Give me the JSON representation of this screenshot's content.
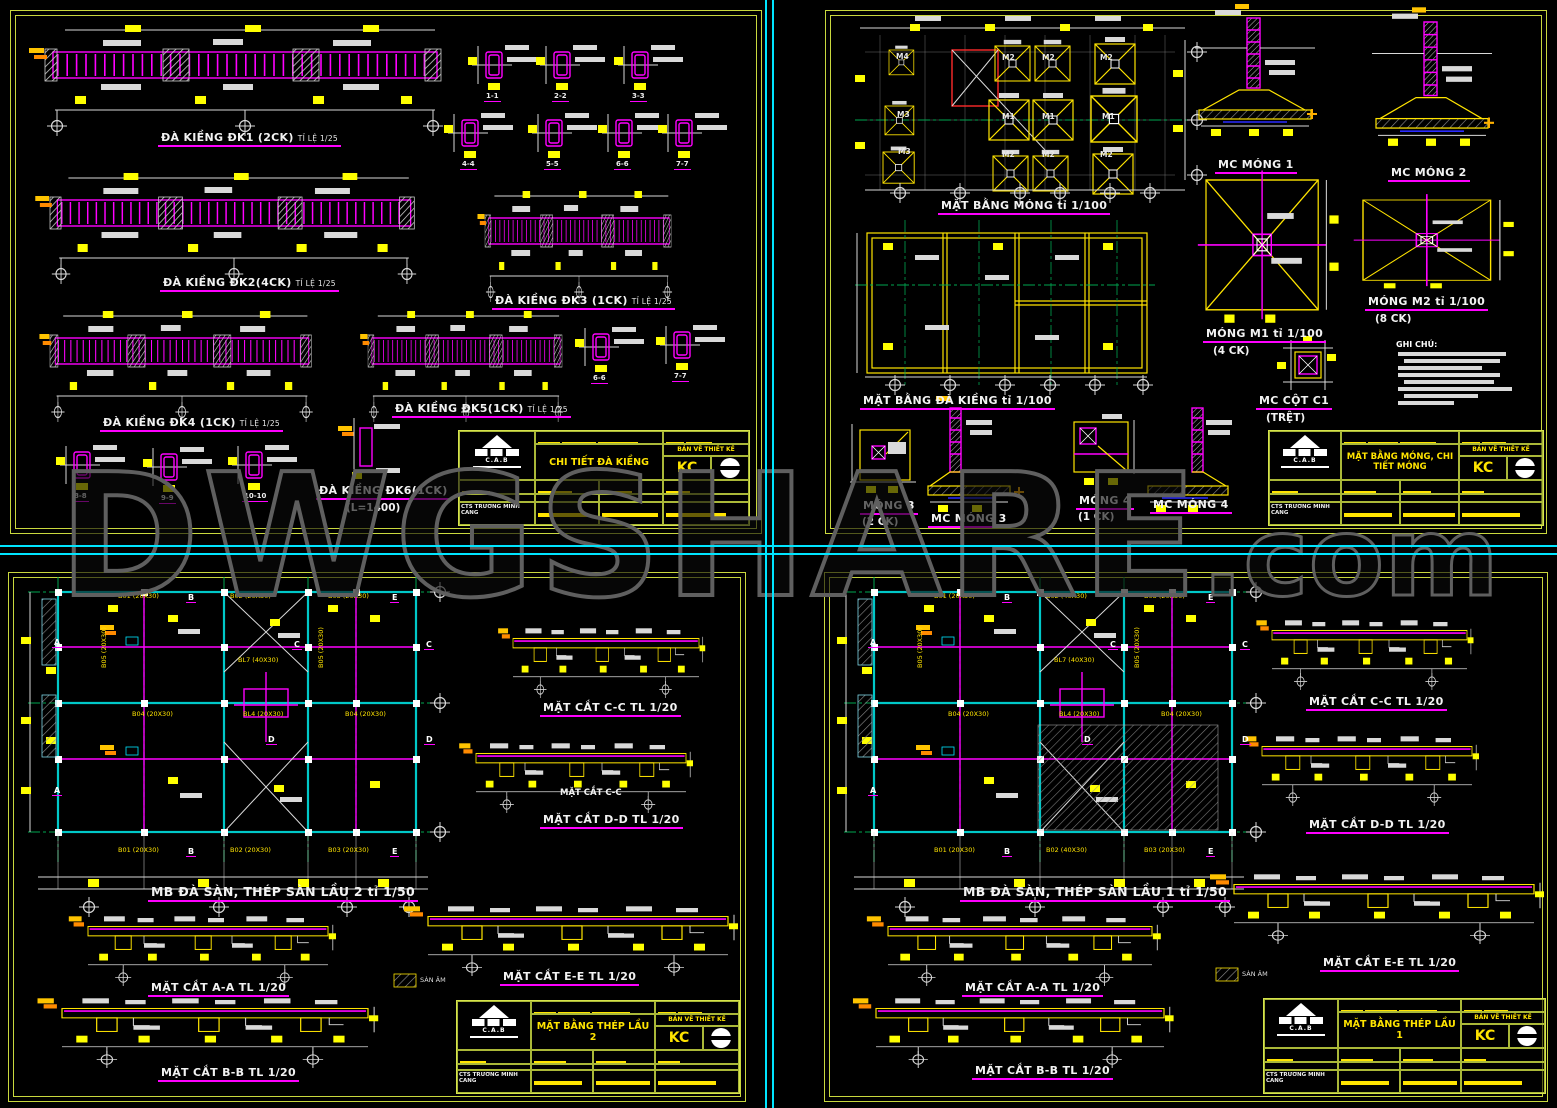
{
  "watermark": {
    "main": "DWGSHARE",
    "tld": ".com"
  },
  "axis": {
    "a": "A",
    "b": "B",
    "c": "C",
    "d": "D",
    "e": "E"
  },
  "titleblock_common": {
    "doc_type": "BẢN VẼ THIẾT KẾ",
    "code": "KC",
    "firm": "CTS TRƯƠNG MINH CANG",
    "logo": "C.A.B"
  },
  "sheets": {
    "tl": {
      "title": "CHI TIẾT ĐÀ KIỀNG",
      "labels": {
        "dk1": "ĐÀ KIỀNG ĐK1 (2CK)",
        "dk2": "ĐÀ KIỀNG ĐK2(4CK)",
        "dk3": "ĐÀ KIỀNG ĐK3 (1CK)",
        "dk4": "ĐÀ KIỀNG ĐK4 (1CK)",
        "dk5": "ĐÀ KIỀNG ĐK5(1CK)",
        "dk6": "ĐÀ KIỀNG ĐK6(1CK)",
        "dk6_sub": "(L=1400)",
        "scale_25": "TỈ LỆ 1/25"
      },
      "sections": {
        "s11": "1-1",
        "s22": "2-2",
        "s33": "3-3",
        "s44": "4-4",
        "s55": "5-5",
        "s66": "6-6",
        "s77": "7-7",
        "s88": "8-8",
        "s99": "9-9",
        "s1010": "10-10"
      }
    },
    "tr": {
      "title": "MẶT BẰNG MÓNG, CHI TIẾT MÓNG",
      "labels": {
        "plan_mong": "MẶT BẰNG MÓNG tỉ 1/100",
        "plan_dakieng": "MẶT BẰNG ĐÀ KIỀNG tỉ 1/100",
        "mc_mong1": "MC MÓNG 1",
        "mc_mong2": "MC MÓNG 2",
        "mong_m1": "MÓNG M1 tỉ 1/100",
        "mong_m1_sub": "(4 CK)",
        "mong_m2": "MÓNG M2 tỉ 1/100",
        "mong_m2_sub": "(8 CK)",
        "mong3": "MÓNG 3",
        "mong3_sub": "(2 CK)",
        "mc_mong3": "MC MÓNG 3",
        "mong4": "MÓNG 4",
        "mong4_sub": "(1 CK)",
        "mc_mong4": "MC MÓNG 4",
        "mc_cot": "MC CỘT C1",
        "mc_cot_sub": "(TRỆT)",
        "ghichu": "GHI CHÚ:"
      },
      "footings": {
        "m1": "M1",
        "m2": "M2",
        "m3": "M3",
        "m4": "M4"
      }
    },
    "bl": {
      "title": "MẶT BẰNG THÉP LẦU 2",
      "labels": {
        "plan": "MB ĐÀ SÀN, THÉP SÀN LẦU 2 tỉ 1/50",
        "cut_cc": "MẶT CẮT C-C TL 1/20",
        "cut_cc_plain": "MẶT CẮT C-C",
        "cut_dd": "MẶT CẮT D-D TL 1/20",
        "cut_aa": "MẶT CẮT A-A TL 1/20",
        "cut_bb": "MẶT CẮT B-B TL 1/20",
        "cut_ee": "MẶT CẮT E-E TL 1/20",
        "san_am": "SÀN ÂM"
      },
      "beams": {
        "b01": "B01 (20X30)",
        "b02": "B02 (20X30)",
        "b03": "B03 (20X30)",
        "b04": "B04 (20X30)",
        "bl4": "BL4 (20X30)",
        "bl7": "BL7 (40X30)",
        "b05": "B05 (20X30)"
      }
    },
    "br": {
      "title": "MẶT BẰNG THÉP LẦU 1",
      "labels": {
        "plan": "MB ĐÀ SÀN, THÉP SÀN LẦU 1 tỉ 1/50",
        "cut_cc": "MẶT CẮT C-C TL 1/20",
        "cut_dd": "MẶT CẮT D-D TL 1/20",
        "cut_aa": "MẶT CẮT A-A TL 1/20",
        "cut_bb": "MẶT CẮT B-B TL 1/20",
        "cut_ee": "MẶT CẮT E-E TL 1/20",
        "san_am": "SÀN ÂM"
      },
      "beams": {
        "b01": "B01 (20X30)",
        "b02": "B02 (40X30)",
        "b03": "B03 (20X30)",
        "b04": "B04 (20X30)",
        "bl4": "BL4 (20X30)",
        "bl7": "BL7 (40X30)",
        "b05": "B05 (20X30)"
      }
    }
  }
}
